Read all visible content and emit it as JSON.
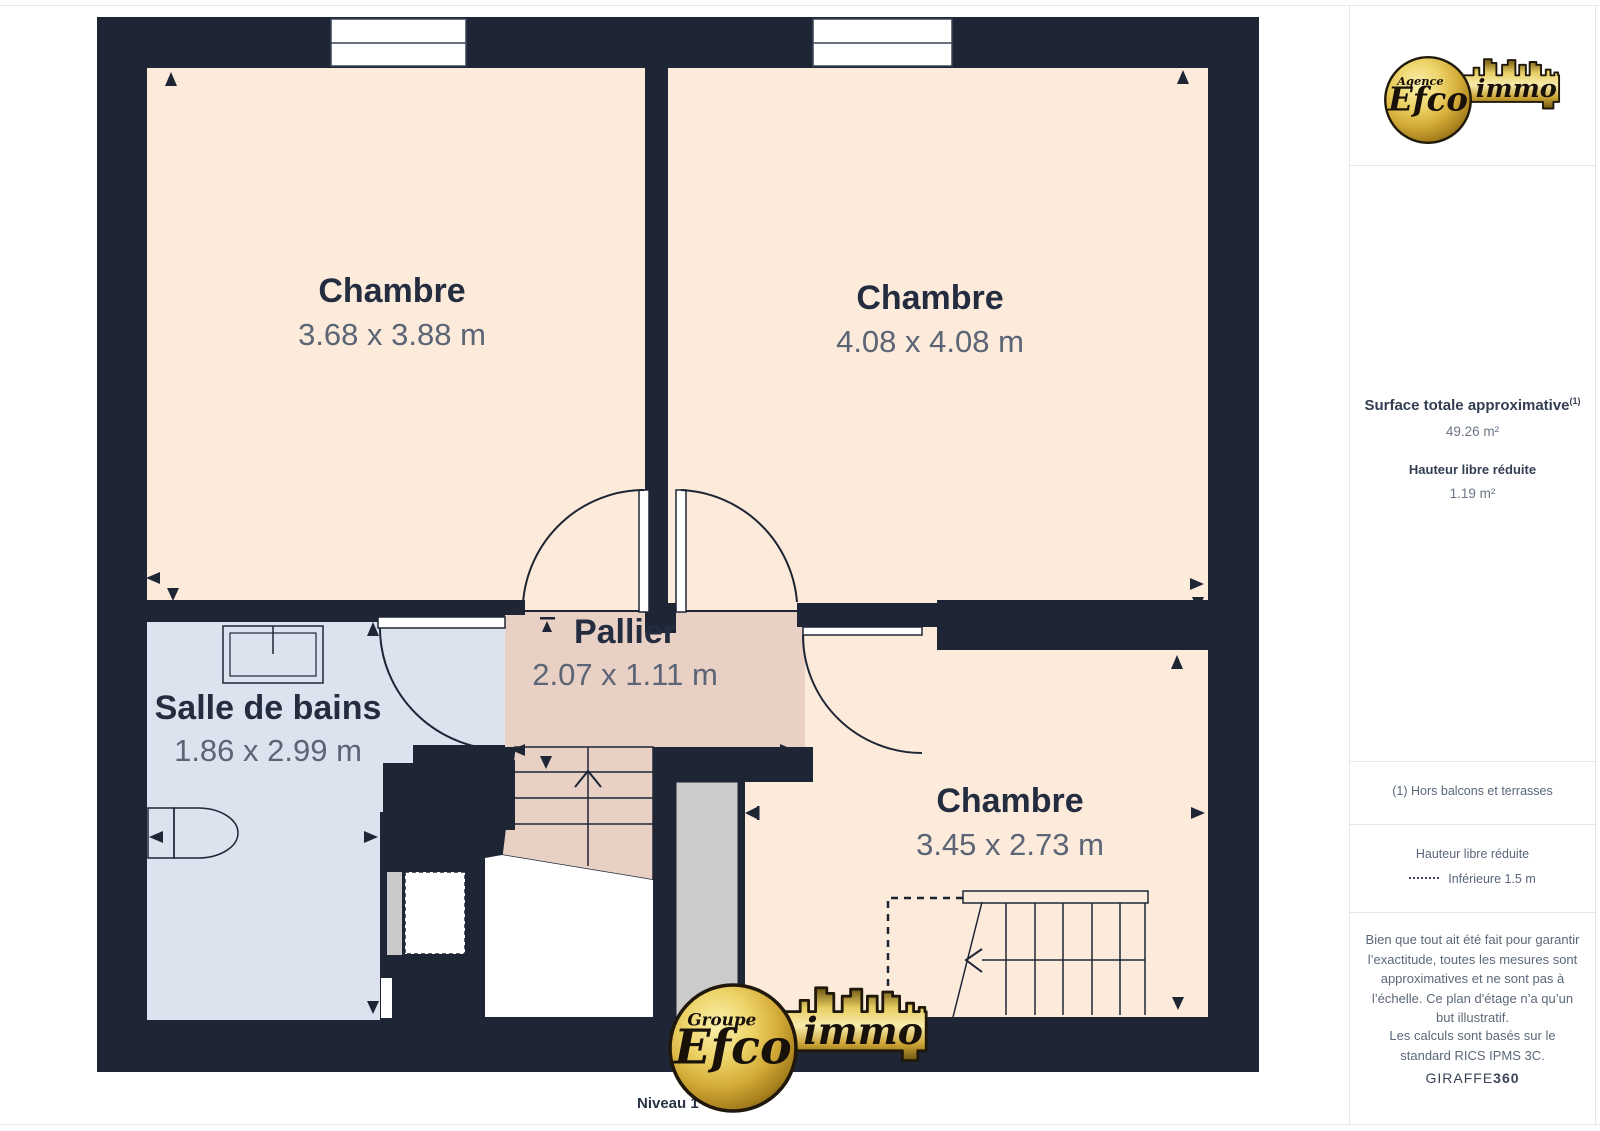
{
  "page": {
    "level_label": "Niveau 1"
  },
  "plan": {
    "rooms": [
      {
        "id": "chambre-1",
        "name": "Chambre",
        "dims": "3.68 x 3.88 m"
      },
      {
        "id": "chambre-2",
        "name": "Chambre",
        "dims": "4.08 x 4.08 m"
      },
      {
        "id": "salle-de-bains",
        "name": "Salle de bains",
        "dims": "1.86 x 2.99 m"
      },
      {
        "id": "pallier",
        "name": "Pallier",
        "dims": "2.07 x 1.11 m"
      },
      {
        "id": "chambre-3",
        "name": "Chambre",
        "dims": "3.45 x 2.73 m"
      }
    ],
    "colors": {
      "wall": "#1e2636",
      "room_fill": "#fceada",
      "landing_fill": "#e9d0c5",
      "bathroom_fill": "#dce2ee",
      "stair_void_fill": "#cbcbcb",
      "label_text": "#242d40",
      "dims_text": "#5c6576"
    }
  },
  "logos": {
    "top": {
      "badge": "Agence",
      "name": "Efco",
      "suffix": "immo"
    },
    "bottom": {
      "badge": "Groupe",
      "name": "Efco",
      "suffix": "immo"
    },
    "gold": "#d4ac38"
  },
  "sidebar": {
    "surface_title": "Surface totale approximative",
    "surface_footnote_marker": "(1)",
    "surface_value": "49.26 m²",
    "reduced_height_title": "Hauteur libre réduite",
    "reduced_height_value": "1.19 m²",
    "footnote": "(1) Hors balcons et terrasses",
    "legend_title": "Hauteur libre réduite",
    "legend_item": "Inférieure 1.5 m",
    "disclaimer": "Bien que tout ait été fait pour garantir l’exactitude, toutes les mesures sont approximatives et ne sont pas à l’échelle. Ce plan d'étage n’a qu’un but illustratif.",
    "standard_note": "Les calculs sont basés sur le standard RICS IPMS 3C.",
    "brand": "GIRAFFE",
    "brand_suffix": "360"
  }
}
